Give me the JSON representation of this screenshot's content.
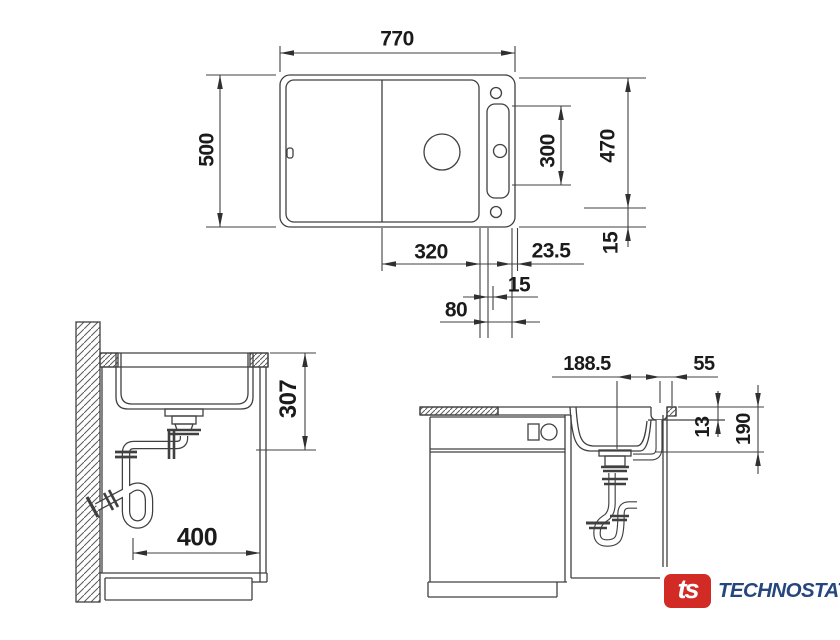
{
  "top_view": {
    "overall_width": "770",
    "overall_depth": "500",
    "cutout_depth": "470",
    "holes_span": "300",
    "bowl_width": "320",
    "edge_offset": "23.5",
    "side_margin": "15",
    "hole_offset": "15",
    "drain_offset": "80"
  },
  "side_view": {
    "mounting_depth": "307",
    "cabinet_width": "400"
  },
  "front_view": {
    "drain_position": "188.5",
    "overflow_offset": "55",
    "rim_height": "13",
    "bowl_depth": "190"
  },
  "logo": {
    "badge_text": "ts",
    "brand_text": "TECHNOSTATUS",
    "badge_color": "#d22b26",
    "text_color": "#26477d"
  }
}
